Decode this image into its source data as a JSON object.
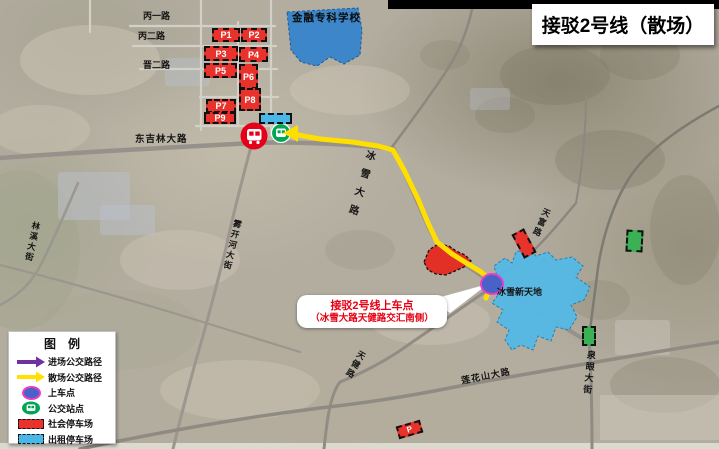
{
  "header": {
    "title": "接驳2号线（散场）"
  },
  "map_labels": {
    "school": "金融专科学校",
    "venue": "冰雪新天地",
    "road_bing_yi": "丙一路",
    "road_bing_er": "丙二路",
    "road_jin_er": "晋二路",
    "road_dongjilin": "东吉林大路",
    "road_bingxue": "冰雪大路",
    "road_wukaihe": "雾开河大街",
    "road_linxi": "林溪大街",
    "road_tianfu": "天富路",
    "road_tianjian": "天健路",
    "road_lianhuashan": "莲花山大路",
    "road_quanyan": "泉眼大街"
  },
  "parking_lots": {
    "p1": "P1",
    "p2": "P2",
    "p3": "P3",
    "p4": "P4",
    "p5": "P5",
    "p6": "P6",
    "p7": "P7",
    "p8": "P8",
    "p9": "P9",
    "p_generic": "P"
  },
  "callout": {
    "line1": "接驳2号线上车点",
    "line2": "（冰雪大路天健路交汇南侧）"
  },
  "legend": {
    "title": "图　例",
    "items": [
      {
        "label": "进场公交路径",
        "symbol": "purple-arrow",
        "color": "#7030a0"
      },
      {
        "label": "散场公交路径",
        "symbol": "yellow-arrow",
        "color": "#ffe100"
      },
      {
        "label": "上车点",
        "symbol": "boarding-dot",
        "color": "#4862c8"
      },
      {
        "label": "公交站点",
        "symbol": "bus-station",
        "color": "#00a651"
      },
      {
        "label": "社会停车场",
        "symbol": "red-dashed-rect",
        "color": "#e8322c"
      },
      {
        "label": "出租停车场",
        "symbol": "cyan-dashed-rect",
        "color": "#49b8e8"
      }
    ]
  },
  "colors": {
    "departure_route": "#ffe100",
    "arrival_route": "#7030a0",
    "boarding_dot": "#4862c8",
    "boarding_ring": "#e83cc8",
    "bus_stop_red": "#e50019",
    "bus_station_green": "#00a651",
    "public_parking": "#e8322c",
    "taxi_parking": "#49b8e8",
    "school_fill": "#3c86c9",
    "venue_fill": "#55b9e6",
    "green_lot": "#3cb054"
  }
}
